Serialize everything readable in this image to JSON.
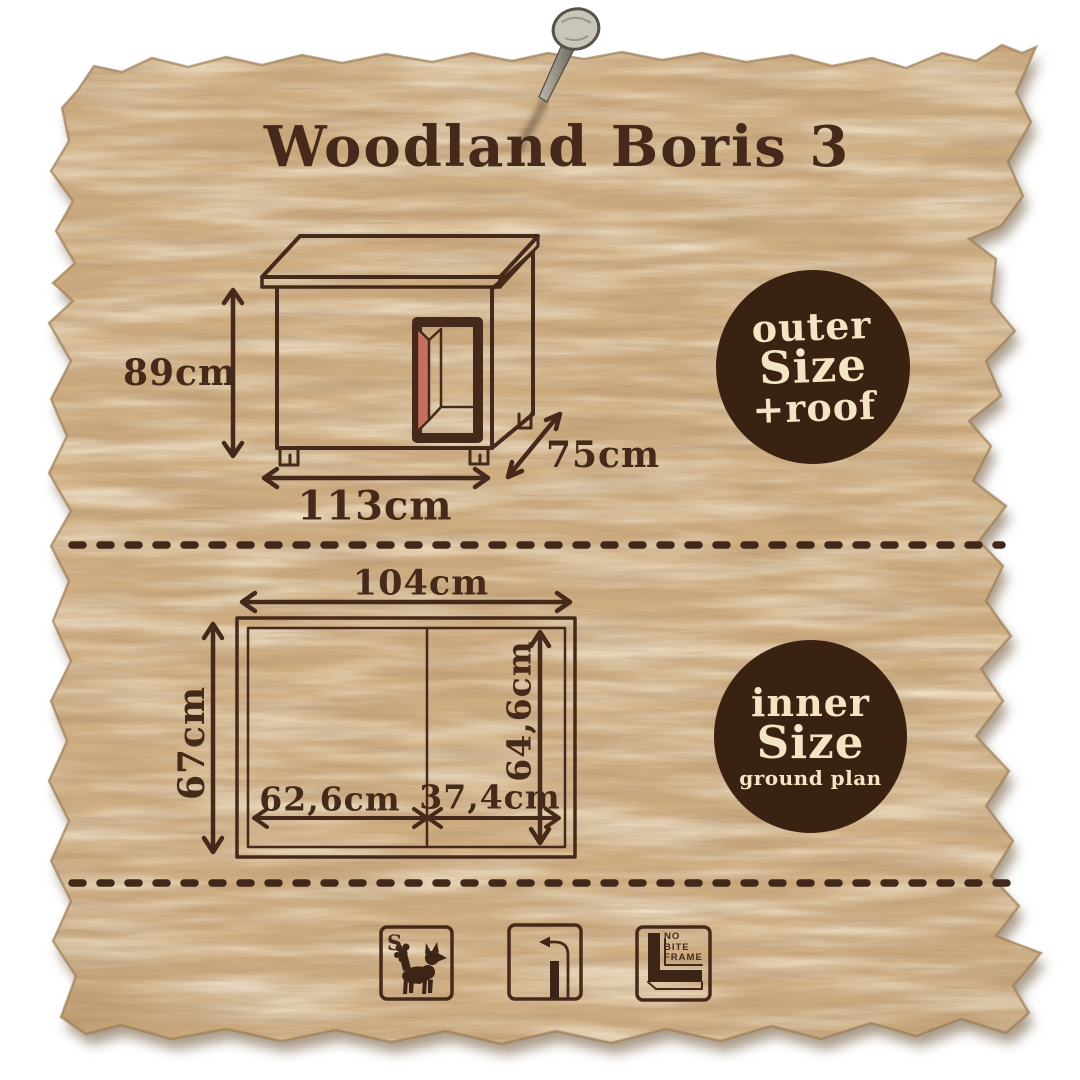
{
  "title": "Woodland Boris 3",
  "outer": {
    "badge": {
      "line1": "outer",
      "line2": "Size",
      "line3": "+roof"
    },
    "height_label": "89cm",
    "width_label": "113cm",
    "depth_label": "75cm"
  },
  "inner": {
    "badge": {
      "line1": "inner",
      "line2": "Size",
      "sub": "ground plan"
    },
    "width_label": "104cm",
    "height_label": "67cm",
    "inner_height_label": "64,6cm",
    "left_width_label": "62,6cm",
    "right_width_label": "37,4cm"
  },
  "footer_icons": {
    "size_letter": "S",
    "no_bite_line1": "NO",
    "no_bite_line2": "BITE",
    "no_bite_line3": "FRAME"
  },
  "colors": {
    "ink": "#45291a",
    "badge_bg": "#3a2212",
    "badge_text": "#f3e4c4",
    "door_accent": "#c7705e",
    "wood_base": "#cead81"
  }
}
